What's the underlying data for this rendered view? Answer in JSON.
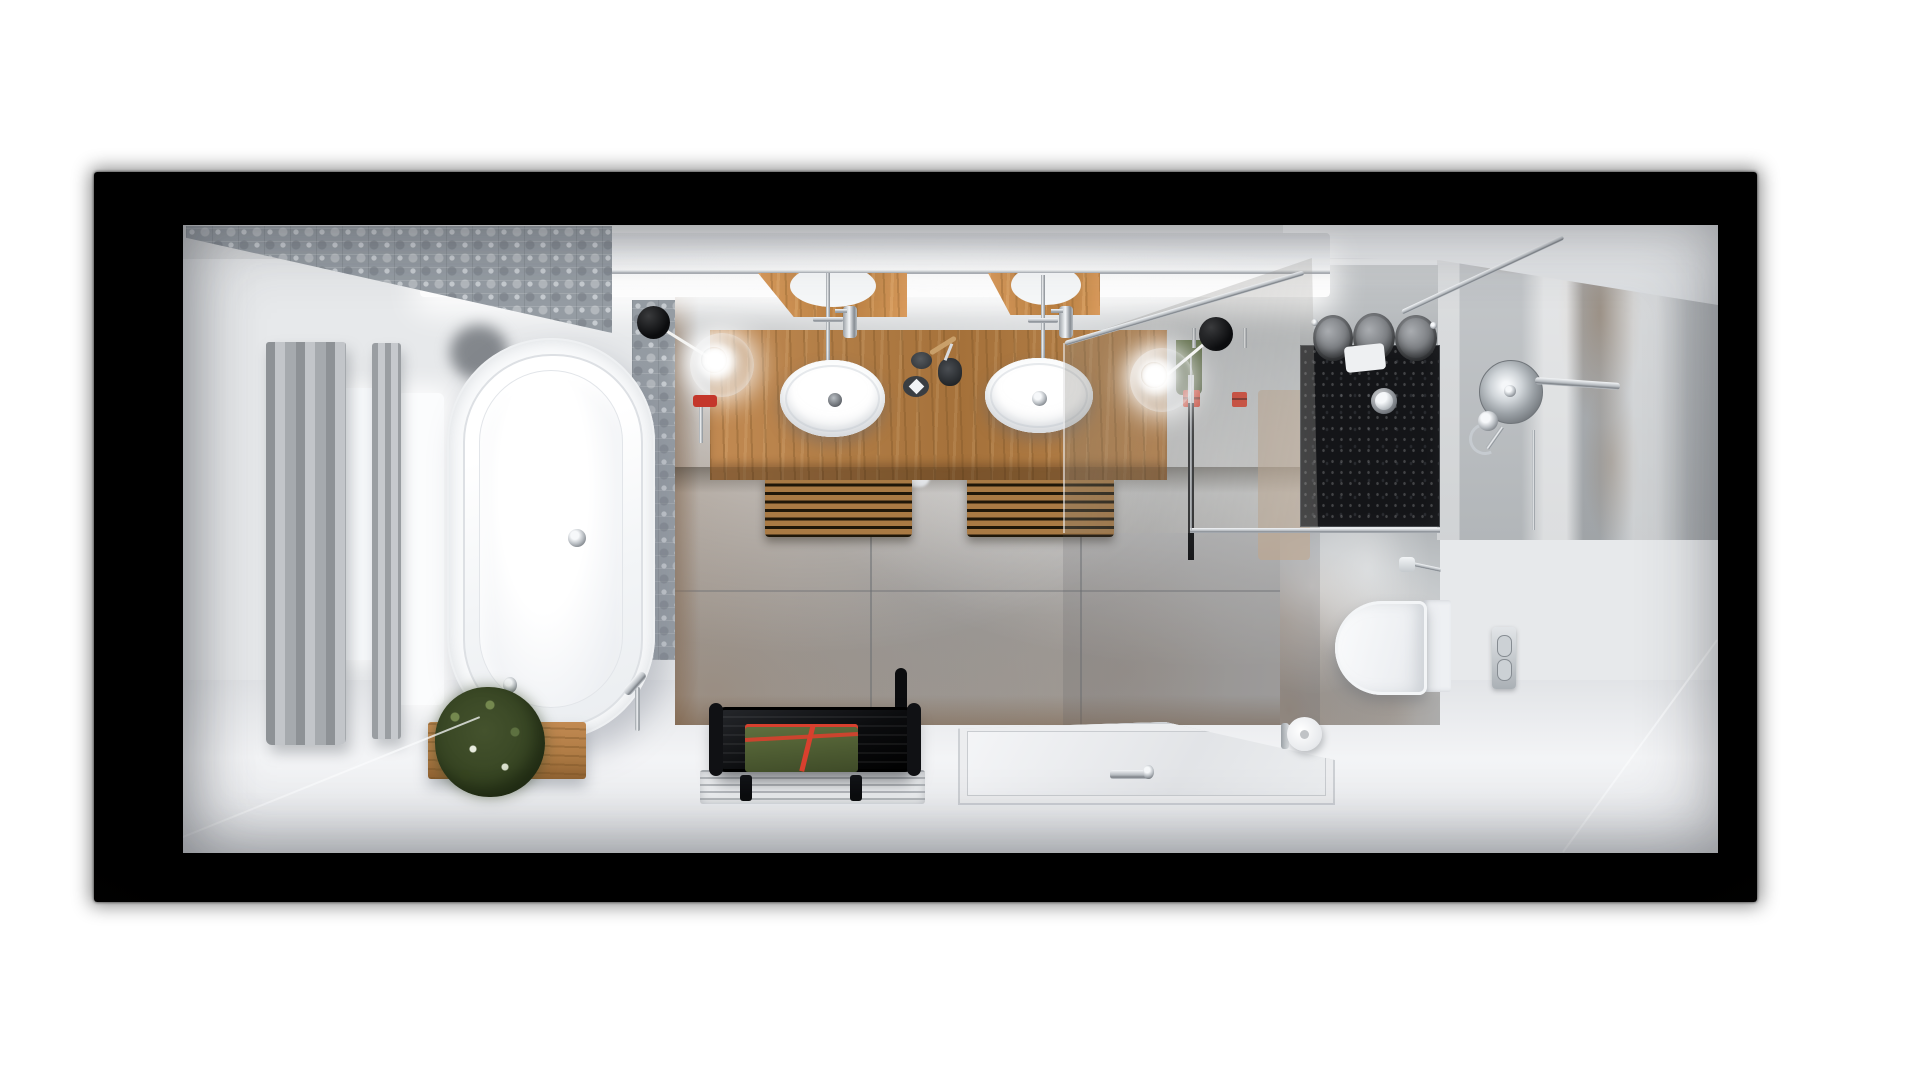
{
  "scene": {
    "description": "Photorealistic top-down 3D render of a long narrow modern bathroom, presented inside a black vignette frame on a white page",
    "view": "plan view (bird's eye) with wide-angle perspective",
    "visible_text": "none"
  },
  "colors": {
    "wall": "#e7e9eb",
    "floor": "#e9ebed",
    "ceiling": "#d8dadc",
    "glow": "#ffffff",
    "pattern_base": "#959ca3",
    "pattern_light": "#c6cbd0",
    "tile_gray": "#b2b6b9",
    "rust": "#85664a",
    "wood": "#b07c45",
    "wood_light": "#c28a52",
    "wood_dark": "#7a5526",
    "curtain_dark": "#8e9296",
    "curtain_light": "#c2c5c9",
    "porcelain": "#fbfcfd",
    "shower_black": "#141518",
    "marble": "#c2c5c8",
    "bench_black": "#0c0d0f",
    "towel_green": "#556538",
    "towel_green_dark": "#414e28",
    "towel_red": "#d8402e",
    "towel_gray": "#7f8286",
    "plant_green": "#44522d",
    "plant_light": "#74884e",
    "chrome": "#c6cbd0",
    "frame_black": "#070606"
  },
  "objects": {
    "frame": {
      "label": "black presentation frame around room"
    },
    "pattern_tiles": {
      "label": "ornate patterned gray accent tiles, top-left wall"
    },
    "accent_strip": {
      "label": "patterned tile accent strip beside bathtub"
    },
    "led_cove": {
      "label": "backlit LED cove above vanity wall"
    },
    "curtain": {
      "label": "gray window curtain"
    },
    "window": {
      "label": "bright window light"
    },
    "bathtub": {
      "label": "white freestanding oval bathtub with chrome drain"
    },
    "tub_filler": {
      "label": "chrome floor-standing tub filler"
    },
    "hand_shower_tub": {
      "label": "chrome hand shower at tub edge"
    },
    "planter": {
      "label": "wooden planter box with green plant"
    },
    "vanity": {
      "label": "oak double vanity counter"
    },
    "mirror_left": {
      "label": "tilted vanity mirror (left)"
    },
    "mirror_right": {
      "label": "tilted vanity mirror (right)"
    },
    "sink_left": {
      "label": "white oval countertop basin (left)"
    },
    "sink_right": {
      "label": "white oval countertop basin (right)"
    },
    "faucet_left": {
      "label": "chrome basin faucet (left)"
    },
    "faucet_right": {
      "label": "chrome basin faucet (right)"
    },
    "soap_dish": {
      "label": "dark round soap dish"
    },
    "soap_tray": {
      "label": "dark tray with white diamond soap"
    },
    "toothbrush_cup": {
      "label": "black cup with toothbrushes"
    },
    "pendant_left": {
      "label": "glass globe pendant lamp with black canopy (left)"
    },
    "pendant_right": {
      "label": "glass globe pendant lamp with black canopy (right)"
    },
    "towel_rack_left": {
      "label": "wooden slatted towel rack with white towel (left)"
    },
    "towel_rack_right": {
      "label": "wooden slatted towel rack with white towel (right)"
    },
    "wall_tiles": {
      "label": "large-format gray stone tiles with rust veining"
    },
    "glass_panel": {
      "label": "walk-in shower glass panel with chrome support bars"
    },
    "shower_column": {
      "label": "shower column and hanging green/red towels behind glass"
    },
    "shower_tray": {
      "label": "black stone shower base with round drain"
    },
    "rolled_towels": {
      "label": "gray rolled towels on shower shelf"
    },
    "rain_shower": {
      "label": "round chrome rain shower head with wall arm"
    },
    "marble_wall": {
      "label": "marble-textured right wall"
    },
    "toilet": {
      "label": "white wall-hung toilet"
    },
    "flush_plate": {
      "label": "chrome flush plate"
    },
    "paper_roll": {
      "label": "spare toilet paper roll on holder"
    },
    "bench": {
      "label": "black slatted bath bench"
    },
    "bench_towel": {
      "label": "green towel with red trim on bench"
    },
    "floor_mat": {
      "label": "recessed white slatted floor mat"
    },
    "shower_mat": {
      "label": "white floor-level shower tray with chrome fitting"
    },
    "floor": {
      "label": "seamless white bathroom floor"
    }
  }
}
